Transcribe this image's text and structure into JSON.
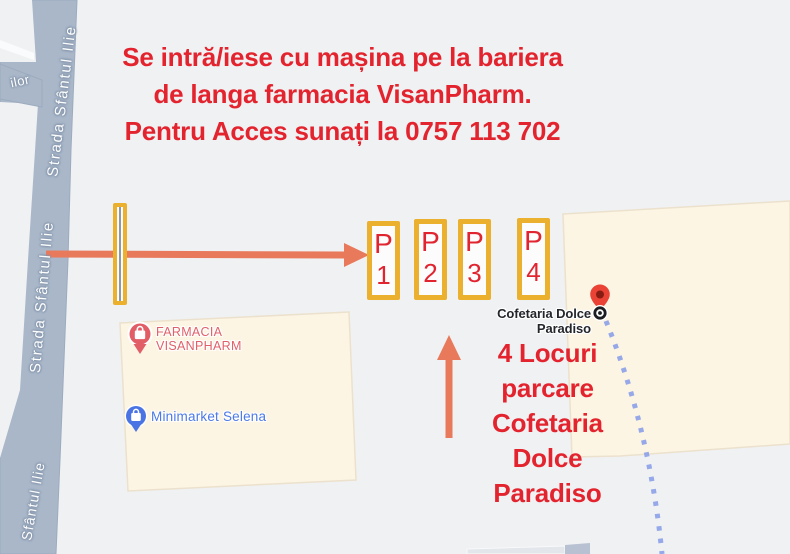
{
  "annotations": {
    "instructions": {
      "lines": [
        "Se intră/iese cu mașina pe la bariera",
        "de langa farmacia VisanPharm.",
        "Pentru Acces sunați la 0757 113 702"
      ]
    },
    "parking_note": {
      "lines": [
        "4 Locuri",
        "parcare",
        "Cofetaria",
        "Dolce",
        "Paradiso"
      ]
    },
    "parking_spots": [
      {
        "label": "P",
        "number": "1"
      },
      {
        "label": "P",
        "number": "2"
      },
      {
        "label": "P",
        "number": "3"
      },
      {
        "label": "P",
        "number": "4"
      }
    ]
  },
  "map": {
    "roads": {
      "upper": "Strada Sfântul Ilie",
      "mid": "Strada Sfântul Ilie",
      "lower": "Sfântul Ilie",
      "branch": "ilor"
    },
    "pois": {
      "pharmacy": {
        "line1": "FARMACIA",
        "line2": "VISANPHARM"
      },
      "minimarket": {
        "name": "Minimarket Selena"
      },
      "cofetaria": {
        "name": "Cofetaria Dolce Paradiso"
      }
    }
  },
  "colors": {
    "annotation_red": "#e3242e",
    "arrow_coral": "#e8795b",
    "spot_border_yellow": "#eab02e",
    "road_fill": "#a9b7c9",
    "building_fill": "#fcf5e4",
    "pharmacy_label_red": "#e0606a",
    "minimarket_label_blue": "#4c79e6",
    "route_dotted_blue": "#8ba0e8",
    "destination_pin_red": "#ea4335",
    "map_background": "#f0f1f3"
  }
}
